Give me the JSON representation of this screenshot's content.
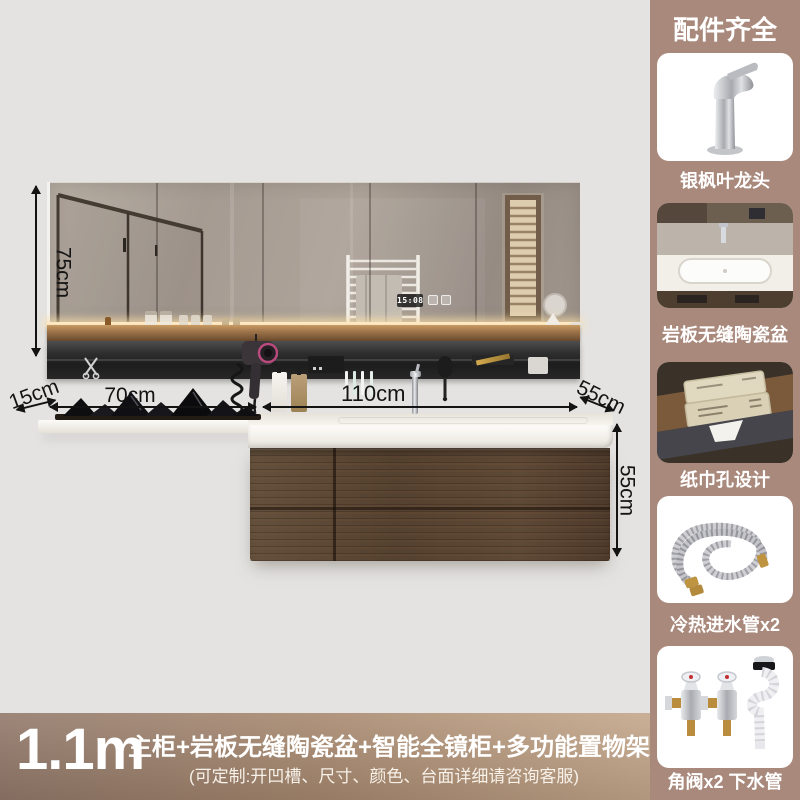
{
  "scene": {
    "mirror_clock_time": "15:08",
    "dimensions": {
      "mirror_height": "75cm",
      "shelf_depth": "15cm",
      "shelf_width": "70cm",
      "cabinet_width": "110cm",
      "counter_depth": "55cm",
      "cabinet_height": "55cm"
    }
  },
  "sidebar": {
    "title": "配件齐全",
    "items": [
      {
        "name": "faucet",
        "label": "银枫叶龙头"
      },
      {
        "name": "ceramic-basin",
        "label": "岩板无缝陶瓷盆"
      },
      {
        "name": "tissue-hole",
        "label": "纸巾孔设计"
      },
      {
        "name": "inlet-hoses",
        "label": "冷热进水管x2"
      },
      {
        "name": "valves-drain",
        "label": "角阀x2 下水管"
      }
    ]
  },
  "footer": {
    "size": "1.1m",
    "headline": "主柜+岩板无缝陶瓷盆+智能全镜柜+多功能置物架",
    "note": "(可定制:开凹槽、尺寸、颜色、台面详细请咨询客服)"
  },
  "colors": {
    "page_background": "#e4e3e1",
    "sidebar_background": "#a9897c",
    "footer_gradient_left": "#92796a",
    "footer_gradient_right": "#c5a78c",
    "cabinet_wood": "#5a4130",
    "dimension_ink": "#141414",
    "text_on_brown": "#ffffff"
  }
}
